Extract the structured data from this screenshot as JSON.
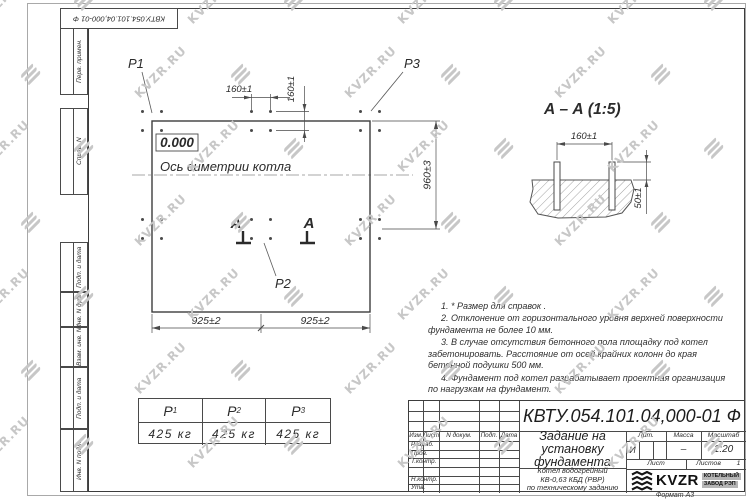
{
  "watermark": {
    "text": "KVZR.RU"
  },
  "margin_columns": {
    "items": [
      "Перв. примен.",
      "Справ. N",
      "Подп. и дата",
      "Инв. N дубл.",
      "Взам. инв. N",
      "Подп. и дата",
      "Инв. N подл."
    ]
  },
  "plan": {
    "level_mark": "0.000",
    "axis_label": "Ось симетрии котла",
    "point_labels": {
      "p1": "P1",
      "p2": "P2",
      "p3": "P3"
    },
    "section_letter": "А",
    "dims": {
      "d160": "160±1",
      "d925": "925±2",
      "d960": "960±3"
    }
  },
  "section": {
    "title": "А – А (1:5)",
    "dims": {
      "d160": "160±1",
      "d50": "50±1"
    }
  },
  "notes": {
    "items": [
      "1.  * Размер для справок .",
      "2.  Отклонение от горизонтального уровня верхней поверхности фундамента не более 10 мм.",
      "3.  В случае отсутствия бетонного пола площадку под котел забетонировать. Расстояние от осей крайних колонн до края бетонной подушки 500 мм.",
      "4.  Фундамент под котел разрабатывает проектная организация по нагрузкам на фундамент."
    ]
  },
  "load_table": {
    "headers": [
      {
        "sym": "Р",
        "sub": "1"
      },
      {
        "sym": "Р",
        "sub": "2"
      },
      {
        "sym": "Р",
        "sub": "3"
      }
    ],
    "values": [
      "425 кг",
      "425 кг",
      "425 кг"
    ]
  },
  "title_block": {
    "designation": "КВТУ.054.101.04,000-01 Ф",
    "doc_title": "Задание на установку фундамента",
    "subtitle_lines": [
      "Котел водогрейный",
      "КВ-0,63 КБД (РВР)",
      "по техническому заданию"
    ],
    "header_cells": [
      "Изм.",
      "Лист",
      "N докум.",
      "Подп.",
      "Дата"
    ],
    "row_labels": [
      "Разраб.",
      "Пров.",
      "Т.контр.",
      "Н.контр.",
      "Утв."
    ],
    "lit_header": [
      "Лит.",
      "Масса",
      "Масштаб"
    ],
    "lit_value": "И",
    "mass_value": "–",
    "scale_value": "1:20",
    "sheet_label": "Лист",
    "sheets_label": "Листов",
    "sheets_value": "1",
    "brand": {
      "name": "KVZR",
      "line1": "КОТЕЛЬНЫЙ",
      "line2": "ЗАВОД РЭП"
    },
    "format_label": "Формат А3"
  }
}
